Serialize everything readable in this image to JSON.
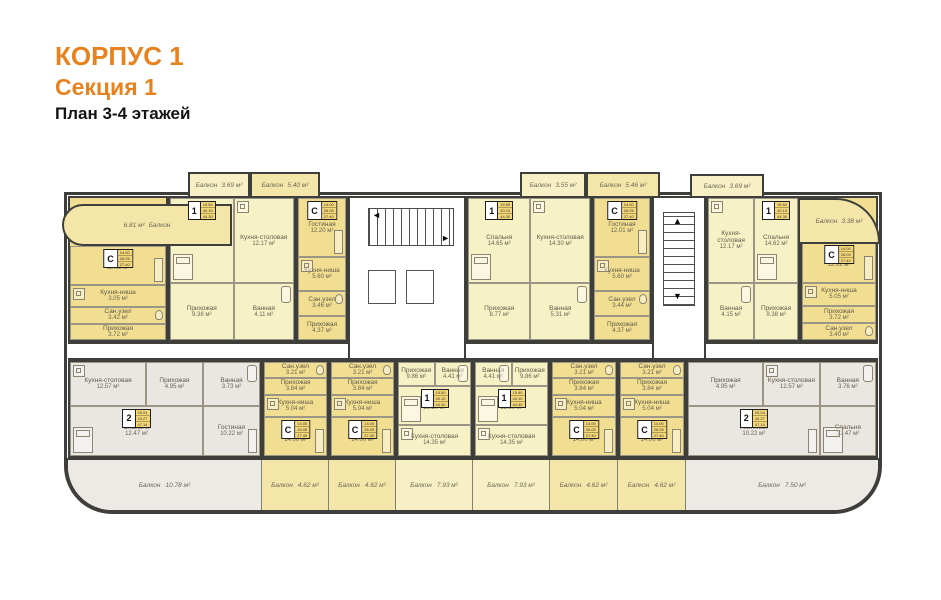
{
  "title": {
    "building": "КОРПУС 1",
    "section": "Секция 1",
    "floors": "План 3-4 этажей"
  },
  "colors": {
    "accent_orange": "#E8821E",
    "studio_fill": "#F1DE90",
    "one_room_fill": "#F7F1C6",
    "two_room_fill": "#EAE6E2",
    "wall": "#3E3E3A"
  },
  "plan": {
    "upper_units": [
      {
        "type": "С",
        "rooms": [
          {
            "name": "Гостиная",
            "area": "12.02 м²"
          },
          {
            "name": "Кухня-ниша",
            "area": "3.05 м²"
          },
          {
            "name": "Сан.узел",
            "area": "3.42 м²"
          },
          {
            "name": "Прихожая",
            "area": "3.72 м²"
          }
        ]
      },
      {
        "type": "1",
        "rooms": [
          {
            "name": "Спальня",
            "area": "14.62 м²"
          },
          {
            "name": "Кухня-столовая",
            "area": "12.17 м²"
          },
          {
            "name": "Прихожая",
            "area": "9.38 м²"
          },
          {
            "name": "Ванная",
            "area": "4.11 м²"
          }
        ]
      },
      {
        "type": "С",
        "rooms": [
          {
            "name": "Гостиная",
            "area": "12.20 м²"
          },
          {
            "name": "Кухня-ниша",
            "area": "5.60 м²"
          },
          {
            "name": "Сан.узел",
            "area": "3.46 м²"
          },
          {
            "name": "Прихожая",
            "area": "4.37 м²"
          }
        ]
      },
      {
        "type": "1",
        "rooms": [
          {
            "name": "Спальня",
            "area": "14.65 м²"
          },
          {
            "name": "Кухня-столовая",
            "area": "14.30 м²"
          },
          {
            "name": "Прихожая",
            "area": "8.77 м²"
          },
          {
            "name": "Ванная",
            "area": "5.31 м²"
          }
        ]
      },
      {
        "type": "С",
        "rooms": [
          {
            "name": "Гостиная",
            "area": "12.01 м²"
          },
          {
            "name": "Кухня-ниша",
            "area": "5.60 м²"
          },
          {
            "name": "Сан.узел",
            "area": "3.44 м²"
          },
          {
            "name": "Прихожая",
            "area": "4.37 м²"
          }
        ]
      },
      {
        "type": "1",
        "rooms": [
          {
            "name": "Кухня-столовая",
            "area": "12.17 м²"
          },
          {
            "name": "Спальня",
            "area": "14.62 м²"
          },
          {
            "name": "Ванная",
            "area": "4.15 м²"
          },
          {
            "name": "Прихожая",
            "area": "9.38 м²"
          }
        ]
      },
      {
        "type": "С",
        "rooms": [
          {
            "name": "Гостиная",
            "area": "12.02 м²"
          },
          {
            "name": "Кухня-ниша",
            "area": "5.05 м²"
          },
          {
            "name": "Прихожая",
            "area": "3.72 м²"
          },
          {
            "name": "Сан.узел",
            "area": "3.40 м²"
          }
        ]
      }
    ],
    "lower_units": [
      {
        "type": "2",
        "rooms": [
          {
            "name": "Кухня-столовая",
            "area": "12.57 м²"
          },
          {
            "name": "Прихожая",
            "area": "4.95 м²"
          },
          {
            "name": "Ванная",
            "area": "3.73 м²"
          },
          {
            "name": "Спальня",
            "area": "12.47 м²"
          },
          {
            "name": "Гостиная",
            "area": "10.22 м²"
          }
        ]
      },
      {
        "type": "С",
        "rooms": [
          {
            "name": "Сан.узел",
            "area": "3.21 м²"
          },
          {
            "name": "Прихожая",
            "area": "3.84 м²"
          },
          {
            "name": "Кухня-ниша",
            "area": "5.04 м²"
          },
          {
            "name": "Гостиная",
            "area": "14.00 м²"
          }
        ]
      },
      {
        "type": "С",
        "rooms": [
          {
            "name": "Сан.узел",
            "area": "3.21 м²"
          },
          {
            "name": "Прихожая",
            "area": "3.84 м²"
          },
          {
            "name": "Кухня-ниша",
            "area": "5.04 м²"
          },
          {
            "name": "Гостиная",
            "area": "14.00 м²"
          }
        ]
      },
      {
        "type": "1",
        "rooms": [
          {
            "name": "Прихожая",
            "area": "9.86 м²"
          },
          {
            "name": "Ванная",
            "area": "4.41 м²"
          },
          {
            "name": "Спальня",
            "area": "15.50 м²"
          },
          {
            "name": "Кухня-столовая",
            "area": "14.35 м²"
          }
        ]
      },
      {
        "type": "1",
        "rooms": [
          {
            "name": "Ванная",
            "area": "4.41 м²"
          },
          {
            "name": "Прихожая",
            "area": "9.86 м²"
          },
          {
            "name": "Спальня",
            "area": "15.50 м²"
          },
          {
            "name": "Кухня-столовая",
            "area": "14.35 м²"
          }
        ]
      },
      {
        "type": "С",
        "rooms": [
          {
            "name": "Сан.узел",
            "area": "3.21 м²"
          },
          {
            "name": "Прихожая",
            "area": "3.84 м²"
          },
          {
            "name": "Кухня-ниша",
            "area": "5.04 м²"
          },
          {
            "name": "Гостиная",
            "area": "14.00 м²"
          }
        ]
      },
      {
        "type": "С",
        "rooms": [
          {
            "name": "Сан.узел",
            "area": "3.21 м²"
          },
          {
            "name": "Прихожая",
            "area": "3.84 м²"
          },
          {
            "name": "Кухня-ниша",
            "area": "5.04 м²"
          },
          {
            "name": "Гостиная",
            "area": "14.00 м²"
          }
        ]
      },
      {
        "type": "2",
        "rooms": [
          {
            "name": "Прихожая",
            "area": "4.95 м²"
          },
          {
            "name": "Кухня-столовая",
            "area": "12.57 м²"
          },
          {
            "name": "Ванная",
            "area": "3.76 м²"
          },
          {
            "name": "Гостиная",
            "area": "10.22 м²"
          },
          {
            "name": "Спальня",
            "area": "12.47 м²"
          }
        ]
      }
    ],
    "top_balconies": [
      {
        "name": "Балкон",
        "area": "6.81 м²"
      },
      {
        "name": "Балкон",
        "area": "3.69 м²"
      },
      {
        "name": "Балкон",
        "area": "5.40 м²"
      },
      {
        "name": "Балкон",
        "area": "3.55 м²"
      },
      {
        "name": "Балкон",
        "area": "5.46 м²"
      },
      {
        "name": "Балкон",
        "area": "3.69 м²"
      },
      {
        "name": "Балкон",
        "area": "3.38 м²"
      }
    ],
    "bottom_balconies": [
      {
        "name": "Балкон",
        "area": "10.78 м²"
      },
      {
        "name": "Балкон",
        "area": "4.62 м²"
      },
      {
        "name": "Балкон",
        "area": "4.62 м²"
      },
      {
        "name": "Балкон",
        "area": "7.93 м²"
      },
      {
        "name": "Балкон",
        "area": "7.93 м²"
      },
      {
        "name": "Балкон",
        "area": "4.62 м²"
      },
      {
        "name": "Балкон",
        "area": "4.62 м²"
      },
      {
        "name": "Балкон",
        "area": "7.50 м²"
      }
    ],
    "badge_tables": {
      "С": [
        "14.00",
        "26.05",
        "27.40"
      ],
      "1": [
        "15.50",
        "40.10",
        "44.30"
      ],
      "2": [
        "25.04",
        "43.27",
        "47.14"
      ]
    }
  }
}
